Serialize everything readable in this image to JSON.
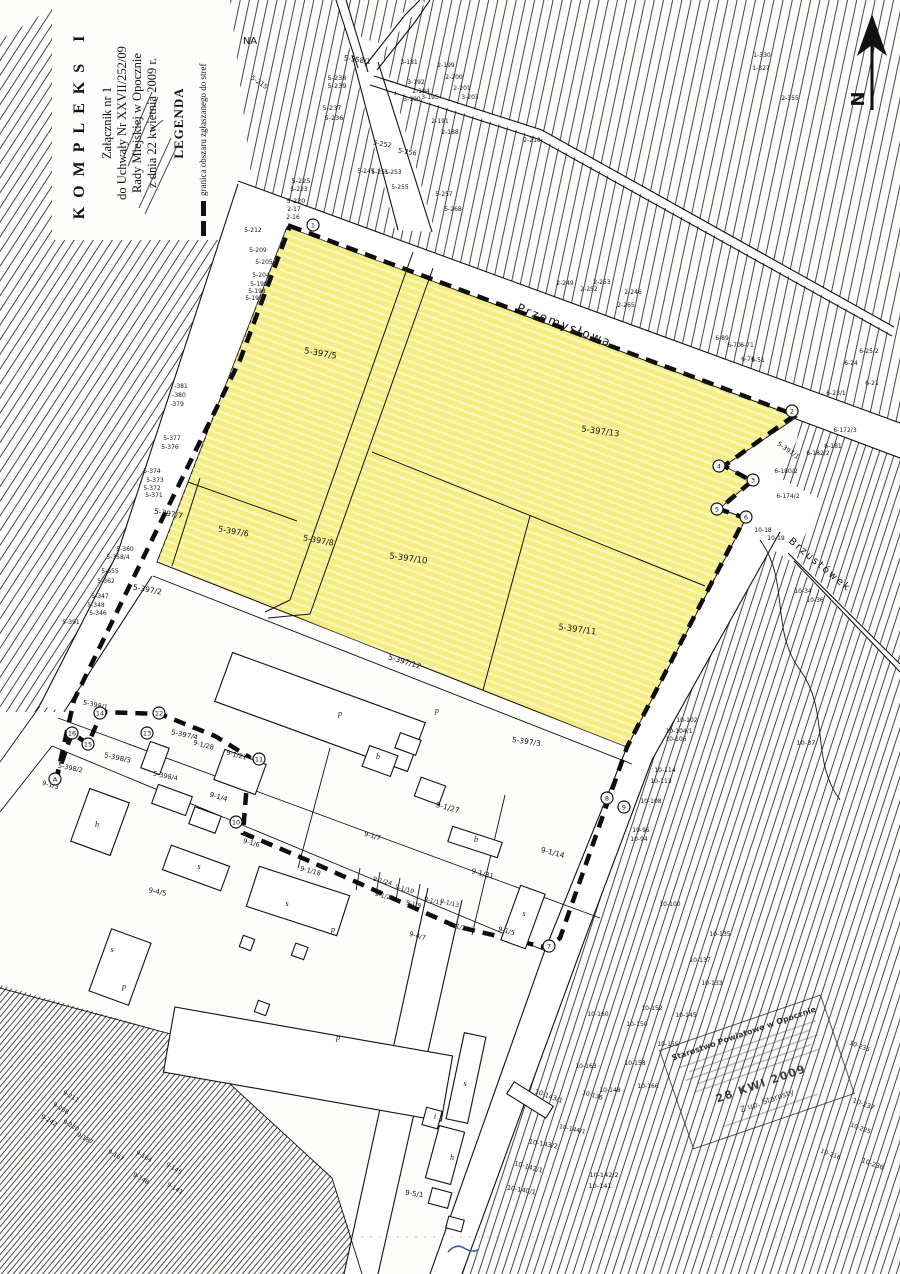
{
  "doc": {
    "kompleks": "KOMPLEKS I",
    "zalacznik": [
      "Załącznik nr 1",
      "do Uchwały Nr XXVII/252/09",
      "Rady Miejskiej w Opocznie",
      "z dnia 22 kwietnia 2009 r."
    ],
    "legenda": "LEGENDA",
    "legend_item": "granica obszaru zgłaszanego do stref",
    "north": "N",
    "handnote": "NA"
  },
  "colors": {
    "highlight": "#f5ee7f",
    "ink": "#151515",
    "stamp_ink": "#2b2b2b",
    "pen_blue": "#3a55b4"
  },
  "stamp": {
    "title": "Starostwo Powiatowe w Opocznie",
    "date": "28 KWI 2009",
    "sig": "Z up. Starosty"
  },
  "map": {
    "streets": [
      [
        "Przemysłowa",
        563,
        329,
        21,
        12
      ],
      [
        "Brzustówek",
        818,
        567,
        40,
        10
      ]
    ],
    "zone_labels": [
      [
        "5-397/5",
        320,
        356,
        10,
        8.5
      ],
      [
        "5-397/13",
        600,
        434,
        8,
        8.5
      ],
      [
        "5-397/6",
        233,
        534,
        10,
        8
      ],
      [
        "5-397/8",
        318,
        543,
        10,
        8
      ],
      [
        "5-397/10",
        408,
        561,
        8,
        8.5
      ],
      [
        "5-397/11",
        577,
        632,
        8,
        8.5
      ],
      [
        "5-397/7",
        168,
        516,
        10,
        7.5
      ],
      [
        "5-397/12",
        404,
        664,
        17,
        7.5
      ],
      [
        "5-397/2",
        147,
        592,
        10,
        7.5
      ],
      [
        "5-397/3",
        526,
        744,
        8,
        7.5
      ]
    ],
    "labels": [
      [
        "NA",
        250,
        44,
        0,
        10
      ],
      [
        "5-358/1",
        357,
        62,
        8,
        7
      ],
      [
        "5-238",
        337,
        80,
        0,
        6.5
      ],
      [
        "5-239",
        337,
        88,
        0,
        6.5
      ],
      [
        "5-237",
        332,
        110,
        0,
        6.5
      ],
      [
        "5-236",
        334,
        120,
        0,
        6.5
      ],
      [
        "5-215",
        258,
        84,
        35,
        6.5
      ],
      [
        "5-225",
        301,
        183,
        0,
        6.5
      ],
      [
        "5-223",
        299,
        191,
        0,
        6
      ],
      [
        "5-220",
        296,
        203,
        0,
        6.5
      ],
      [
        "2-17",
        294,
        211,
        0,
        6
      ],
      [
        "2-16",
        293,
        219,
        0,
        6
      ],
      [
        "5-252",
        382,
        146,
        10,
        6.5
      ],
      [
        "5-256",
        407,
        154,
        10,
        6.5
      ],
      [
        "5-245",
        366,
        173,
        0,
        6
      ],
      [
        "5-251",
        380,
        174,
        0,
        6
      ],
      [
        "5-253",
        393,
        174,
        0,
        6
      ],
      [
        "5-255",
        400,
        189,
        0,
        6
      ],
      [
        "5-257",
        444,
        196,
        0,
        6
      ],
      [
        "5-268",
        453,
        211,
        0,
        6
      ],
      [
        "2-249",
        565,
        285,
        0,
        6
      ],
      [
        "2-253",
        602,
        284,
        0,
        6
      ],
      [
        "2-252",
        589,
        291,
        0,
        6
      ],
      [
        "2-246",
        633,
        294,
        0,
        6
      ],
      [
        "2-265",
        626,
        307,
        0,
        6
      ],
      [
        "3-181",
        409,
        64,
        0,
        6
      ],
      [
        "3-192",
        416,
        84,
        0,
        6
      ],
      [
        "2-194",
        421,
        93,
        0,
        6
      ],
      [
        "3-190",
        412,
        101,
        0,
        6
      ],
      [
        "3-195",
        430,
        99,
        0,
        6
      ],
      [
        "2-199",
        446,
        67,
        0,
        6
      ],
      [
        "2-200",
        454,
        79,
        0,
        6
      ],
      [
        "2-201",
        462,
        90,
        0,
        6
      ],
      [
        "3-203",
        470,
        99,
        0,
        6
      ],
      [
        "2-191",
        440,
        123,
        0,
        6
      ],
      [
        "2-188",
        450,
        134,
        0,
        6
      ],
      [
        "2-218",
        532,
        142,
        0,
        6
      ],
      [
        "1-330",
        762,
        57,
        0,
        6
      ],
      [
        "1-327",
        761,
        70,
        0,
        6
      ],
      [
        "2-355",
        790,
        100,
        0,
        6
      ],
      [
        "6-89",
        722,
        340,
        0,
        6
      ],
      [
        "6-70",
        734,
        347,
        0,
        6
      ],
      [
        "6-71",
        747,
        347,
        0,
        6
      ],
      [
        "6-76",
        748,
        361,
        0,
        6
      ],
      [
        "6-51",
        758,
        362,
        0,
        6
      ],
      [
        "6-25/2",
        869,
        353,
        0,
        6
      ],
      [
        "6-24",
        851,
        365,
        0,
        6
      ],
      [
        "6-21",
        872,
        385,
        0,
        6
      ],
      [
        "6-23/1",
        836,
        395,
        0,
        6
      ],
      [
        "6-172/3",
        845,
        432,
        0,
        6
      ],
      [
        "6-181",
        833,
        448,
        0,
        6
      ],
      [
        "6-182/2",
        818,
        455,
        0,
        6
      ],
      [
        "6-180/2",
        786,
        473,
        0,
        6
      ],
      [
        "6-174/2",
        788,
        498,
        0,
        6
      ],
      [
        "5-397/1",
        787,
        452,
        35,
        6.5
      ],
      [
        "10-18",
        763,
        532,
        0,
        6
      ],
      [
        "10-19",
        776,
        540,
        0,
        6
      ],
      [
        "10-34",
        803,
        593,
        0,
        6
      ],
      [
        "10-36",
        815,
        602,
        0,
        6
      ],
      [
        "10-37",
        806,
        745,
        0,
        6.5
      ],
      [
        "10-102",
        687,
        722,
        0,
        6
      ],
      [
        "10-104/1",
        679,
        733,
        0,
        6
      ],
      [
        "10-106",
        676,
        741,
        0,
        6
      ],
      [
        "10-114",
        665,
        772,
        0,
        6
      ],
      [
        "10-113",
        661,
        783,
        0,
        6
      ],
      [
        "10-108",
        651,
        803,
        0,
        6
      ],
      [
        "10-95",
        641,
        832,
        0,
        6
      ],
      [
        "10-94",
        639,
        841,
        0,
        6
      ],
      [
        "10-100",
        670,
        906,
        0,
        6
      ],
      [
        "10-135",
        720,
        936,
        0,
        6
      ],
      [
        "10-137",
        700,
        962,
        0,
        6
      ],
      [
        "10-133",
        712,
        985,
        0,
        6
      ],
      [
        "10-152",
        652,
        1010,
        0,
        6
      ],
      [
        "10-160",
        598,
        1016,
        0,
        6
      ],
      [
        "10-145",
        686,
        1017,
        0,
        6
      ],
      [
        "10-150",
        637,
        1026,
        0,
        6
      ],
      [
        "10-155",
        668,
        1046,
        0,
        6
      ],
      [
        "10-158",
        635,
        1065,
        0,
        6
      ],
      [
        "10-163",
        586,
        1068,
        0,
        6
      ],
      [
        "10-166",
        648,
        1088,
        0,
        6
      ],
      [
        "10-148",
        610,
        1092,
        0,
        6
      ],
      [
        "10-136",
        592,
        1097,
        15,
        6
      ],
      [
        "10-143/1",
        548,
        1098,
        20,
        6.5
      ],
      [
        "10-144/1",
        572,
        1131,
        12,
        6
      ],
      [
        "10-143/2",
        543,
        1146,
        10,
        6.5
      ],
      [
        "10-142/1",
        528,
        1169,
        15,
        6.5
      ],
      [
        "10-142/2",
        604,
        1177,
        0,
        6.5
      ],
      [
        "10-141",
        600,
        1188,
        0,
        6.5
      ],
      [
        "10-140/1",
        521,
        1192,
        10,
        6.5
      ],
      [
        "10-235",
        859,
        1048,
        20,
        6
      ],
      [
        "10-237",
        863,
        1106,
        20,
        6.5
      ],
      [
        "10-225",
        860,
        1130,
        20,
        6
      ],
      [
        "10-216",
        830,
        1156,
        20,
        6
      ],
      [
        "10-236",
        872,
        1166,
        20,
        6.5
      ],
      [
        "9-1/28",
        203,
        747,
        15,
        6.5
      ],
      [
        "9-1/21",
        236,
        757,
        15,
        6.5
      ],
      [
        "9-1/27",
        447,
        810,
        15,
        7.5
      ],
      [
        "9-1/14",
        552,
        855,
        15,
        7.5
      ],
      [
        "9-1/31",
        482,
        876,
        15,
        7
      ],
      [
        "9-1/4",
        218,
        799,
        15,
        7
      ],
      [
        "9-1/3",
        50,
        787,
        15,
        6.5
      ],
      [
        "9-1/18",
        310,
        873,
        15,
        6.5
      ],
      [
        "9-1/24",
        382,
        883,
        15,
        6
      ],
      [
        "9-1/10",
        404,
        891,
        15,
        6
      ],
      [
        "9-1/23",
        384,
        898,
        15,
        6
      ],
      [
        "9-1/9",
        413,
        906,
        15,
        6
      ],
      [
        "9-1/11",
        433,
        903,
        15,
        6
      ],
      [
        "9-1/13",
        449,
        905,
        15,
        6
      ],
      [
        "9-1/21",
        459,
        929,
        15,
        6.5
      ],
      [
        "9-1/6",
        251,
        845,
        15,
        6.5
      ],
      [
        "9-1/5",
        506,
        933,
        15,
        6.5
      ],
      [
        "9-1/7",
        372,
        838,
        15,
        6.5
      ],
      [
        "9-4/5",
        157,
        894,
        12,
        7
      ],
      [
        "9-4/7",
        417,
        938,
        15,
        6.5
      ],
      [
        "9-5/1",
        414,
        1196,
        8,
        7
      ],
      [
        "5-398/1",
        95,
        707,
        12,
        6.5
      ],
      [
        "5-398/2",
        70,
        770,
        12,
        6.5
      ],
      [
        "5-398/3",
        117,
        760,
        12,
        7
      ],
      [
        "5-398/4",
        165,
        778,
        12,
        6.5
      ],
      [
        "5-397/4",
        184,
        737,
        12,
        7
      ],
      [
        "5-374",
        152,
        473,
        0,
        6
      ],
      [
        "5-373",
        155,
        482,
        0,
        6
      ],
      [
        "5-372",
        152,
        490,
        0,
        6
      ],
      [
        "5-371",
        154,
        497,
        0,
        6
      ],
      [
        "5-655",
        110,
        573,
        0,
        6
      ],
      [
        "5-362",
        106,
        583,
        0,
        6
      ],
      [
        "5-347",
        100,
        598,
        0,
        6
      ],
      [
        "5-348",
        96,
        607,
        0,
        6
      ],
      [
        "5-346",
        98,
        615,
        0,
        6
      ],
      [
        "5-391",
        71,
        624,
        0,
        6
      ],
      [
        "5-360",
        125,
        551,
        0,
        6
      ],
      [
        "5-358/4",
        118,
        559,
        0,
        6
      ],
      [
        "-381",
        181,
        388,
        0,
        6
      ],
      [
        "-380",
        179,
        397,
        0,
        6
      ],
      [
        "-379",
        177,
        406,
        0,
        6
      ],
      [
        "5-377",
        172,
        440,
        0,
        6
      ],
      [
        "5-376",
        170,
        449,
        0,
        6
      ],
      [
        "5-212",
        253,
        232,
        0,
        6
      ],
      [
        "5-209",
        258,
        252,
        0,
        6
      ],
      [
        "5-205",
        264,
        264,
        0,
        6
      ],
      [
        "5-204",
        261,
        277,
        0,
        6
      ],
      [
        "5-199",
        259,
        286,
        0,
        6
      ],
      [
        "5-198",
        257,
        293,
        0,
        6
      ],
      [
        "5-193",
        254,
        300,
        0,
        6
      ],
      [
        "9-211",
        70,
        1098,
        30,
        6
      ],
      [
        "9-208",
        60,
        1110,
        30,
        6
      ],
      [
        "9-242",
        48,
        1122,
        30,
        6
      ],
      [
        "9-220",
        70,
        1127,
        30,
        6
      ],
      [
        "9-187",
        84,
        1140,
        30,
        6
      ],
      [
        "9-167",
        115,
        1157,
        30,
        6
      ],
      [
        "9-164",
        143,
        1158,
        30,
        6
      ],
      [
        "9-145",
        173,
        1170,
        30,
        6
      ],
      [
        "9-148",
        140,
        1180,
        30,
        6
      ],
      [
        "9-141",
        174,
        1190,
        30,
        6
      ]
    ],
    "building_letters": [
      [
        "p",
        340,
        716
      ],
      [
        "p",
        437,
        713
      ],
      [
        "s",
        287,
        906
      ],
      [
        "p",
        333,
        932
      ],
      [
        "p",
        338,
        1040
      ],
      [
        "s",
        465,
        1086
      ],
      [
        "h",
        452,
        1160
      ],
      [
        "i",
        435,
        1119
      ],
      [
        "s",
        112,
        952
      ],
      [
        "p",
        124,
        989
      ],
      [
        "h",
        97,
        827
      ],
      [
        "s",
        199,
        869
      ],
      [
        "b",
        378,
        759
      ],
      [
        "b",
        476,
        842
      ],
      [
        "s",
        524,
        916
      ]
    ],
    "boundary_points": [
      [
        "1",
        313,
        225
      ],
      [
        "2",
        792,
        411
      ],
      [
        "3",
        753,
        480
      ],
      [
        "4",
        719,
        466
      ],
      [
        "5",
        717,
        509
      ],
      [
        "6",
        746,
        517
      ],
      [
        "7",
        549,
        946
      ],
      [
        "8",
        607,
        798
      ],
      [
        "9",
        624,
        807
      ],
      [
        "10",
        236,
        822
      ],
      [
        "11",
        259,
        759
      ],
      [
        "12",
        159,
        713
      ],
      [
        "13",
        147,
        733
      ],
      [
        "14",
        100,
        713
      ],
      [
        "15",
        88,
        744
      ],
      [
        "16",
        72,
        733
      ],
      [
        "A",
        55,
        779
      ]
    ]
  }
}
